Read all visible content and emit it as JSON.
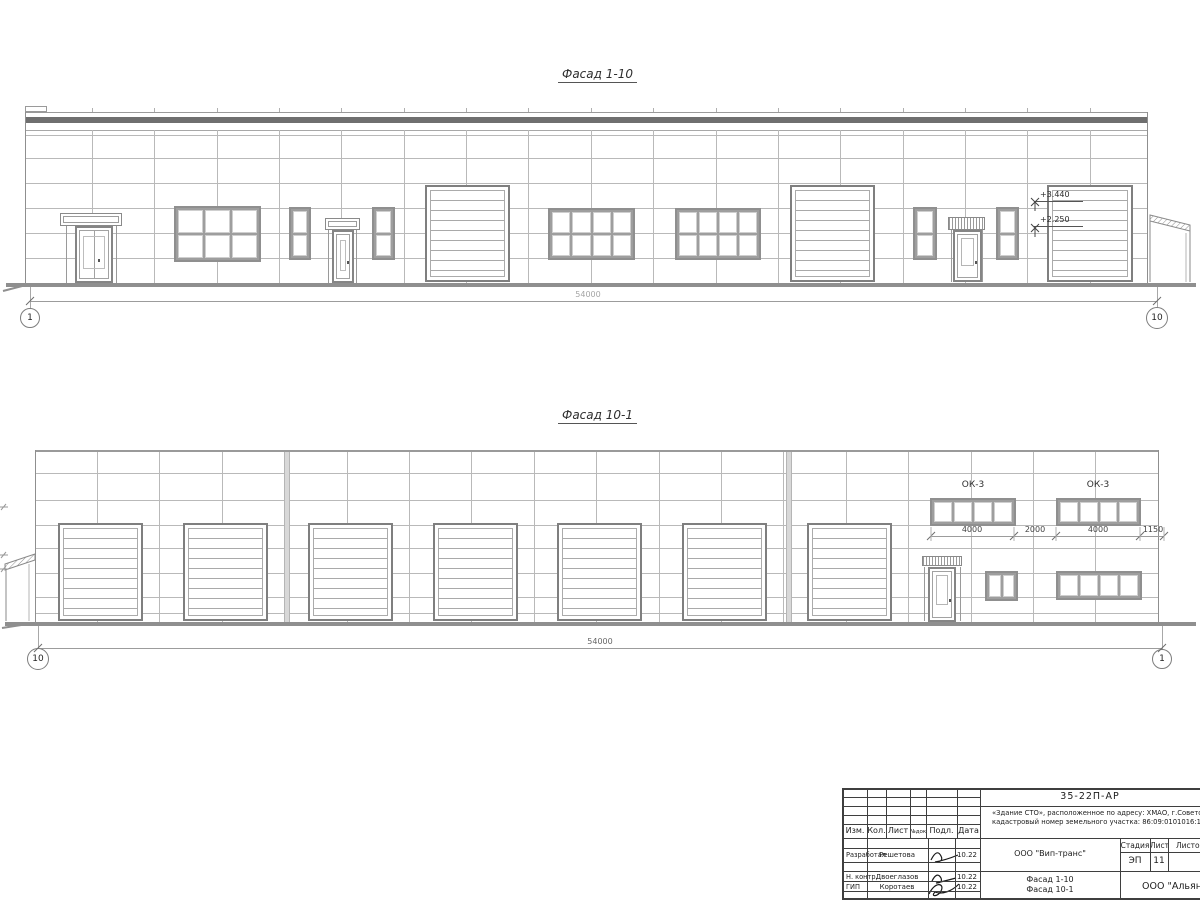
{
  "facade1": {
    "title": "Фасад 1-10",
    "dim_total": "54000",
    "axis_left": "1",
    "axis_right": "10",
    "levels": {
      "upper": "+3.440",
      "lower": "+2.250"
    }
  },
  "facade2": {
    "title": "Фасад 10-1",
    "dim_total": "54000",
    "axis_left": "10",
    "axis_right": "1",
    "window_label_a": "ОК-3",
    "window_label_b": "ОК-3",
    "dims": [
      "4000",
      "2000",
      "4000",
      "1150"
    ]
  },
  "titleblock": {
    "doc_code": "35-22П-АР",
    "address_line1": "«Здание СТО», расположенное по адресу: ХМАО, г.Советский,",
    "address_line2": "кадастровый номер земельного участка: 86:09:0101016:15",
    "columns": [
      "Изм.",
      "Кол.",
      "Лист",
      "№док.",
      "Подл.",
      "Дата"
    ],
    "rows": [
      {
        "role": "Разработал",
        "name": "Решетова",
        "date": "10.22"
      },
      {
        "role": "Н. контр.",
        "name": "Двоеглазов",
        "date": "10.22"
      },
      {
        "role": "ГИП",
        "name": "Коротаев",
        "date": "10.22"
      }
    ],
    "company": "ООО \"Вип-транс\"",
    "stage_label": "Стадия",
    "sheet_label": "Лист",
    "sheets_label": "Листов",
    "stage_value": "ЭП",
    "sheet_value": "11",
    "subject_line1": "Фасад 1-10",
    "subject_line2": "Фасад 10-1",
    "company2": "ООО \"Альянс\""
  }
}
